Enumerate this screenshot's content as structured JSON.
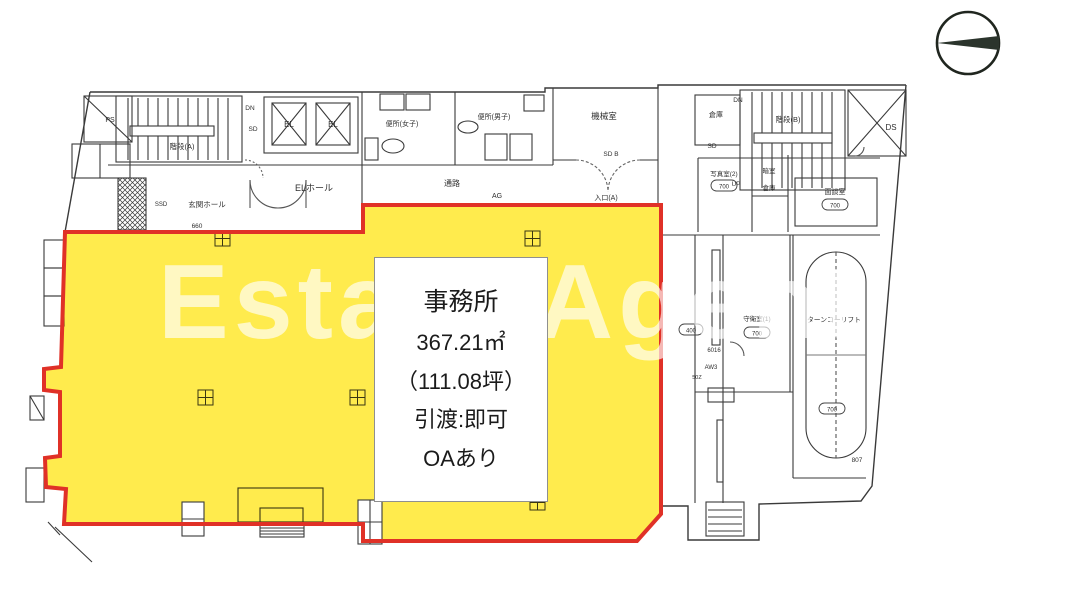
{
  "watermark": "Estate Agent",
  "info": {
    "title": "事務所",
    "line1": "367.21㎡",
    "line2": "（111.08坪）",
    "line3": "引渡:即可",
    "line4": "OAあり"
  },
  "labels": {
    "stair_a": "階段(A)",
    "stair_b": "階段(B)",
    "el1": "EL",
    "el2": "EL",
    "el_hall": "ELホール",
    "entrance_hall": "玄関ホール",
    "ps": "PS",
    "toilet_women": "便所(女子)",
    "toilet_men": "便所(男子)",
    "corridor": "通路",
    "ag": "AG",
    "machine_room": "機械室",
    "entrance": "入口(A)",
    "ds": "DS",
    "storage": "倉庫",
    "photo_room": "写真室(2)",
    "dark_room": "暗室",
    "storage2": "倉庫",
    "meeting_room": "面談室",
    "guard_room": "守衛室(1)",
    "turn_lift": "ターンコーリフト"
  },
  "codes": {
    "ssd": "SSD",
    "c660": "660",
    "dn_a": "DN",
    "sd_a": "SD",
    "sd_door": "SD B",
    "dn_b": "DN",
    "up_b": "UP",
    "sd_b": "SD",
    "c6016": "6016",
    "aw3": "AW3",
    "c50z": "50Z",
    "c807": "807",
    "b700a": "700",
    "b700b": "700",
    "b700c": "700",
    "b700d": "700",
    "b400": "400"
  },
  "colors": {
    "highlight": "#ffe93e",
    "border": "#e03127"
  }
}
